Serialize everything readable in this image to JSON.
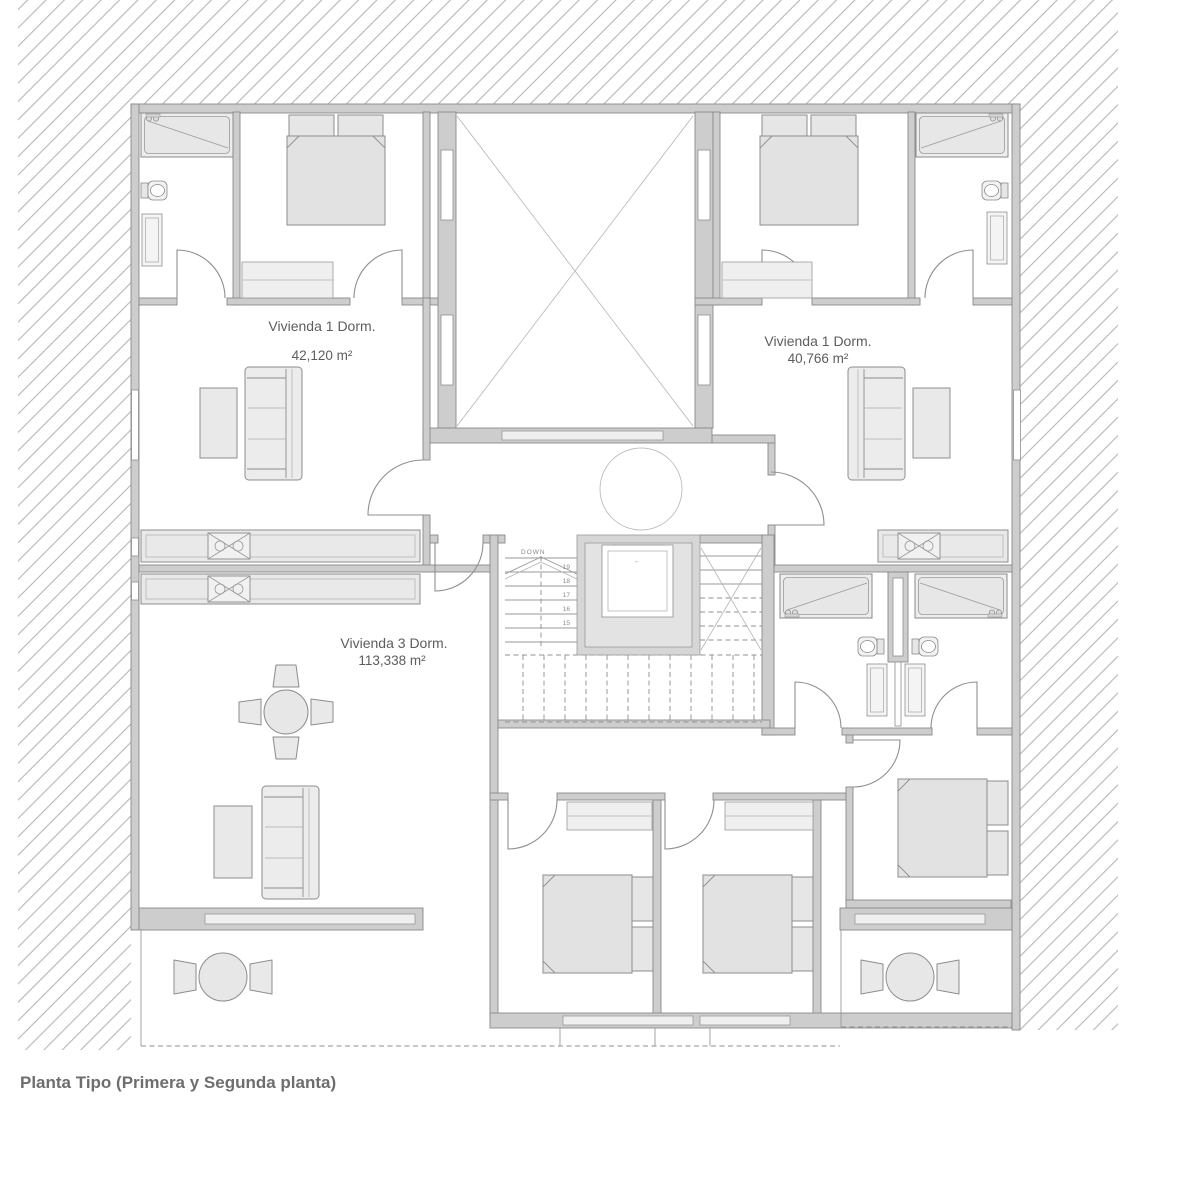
{
  "caption": "Planta Tipo (Primera y Segunda planta)",
  "units": [
    {
      "name": "Vivienda  1 Dorm.",
      "area": "42,120 m²"
    },
    {
      "name": "Vivienda 1 Dorm.",
      "area": "40,766 m²"
    },
    {
      "name": "Vivienda 3 Dorm.",
      "area": "113,338 m²"
    }
  ],
  "stairs": {
    "down_label": "DOWN",
    "tread_numbers": [
      "19",
      "18",
      "17",
      "16",
      "15"
    ]
  },
  "elevator": {
    "symbol": "←"
  },
  "colors": {
    "background": "#ffffff",
    "wall_fill": "#cdcdcd",
    "wall_stroke": "#8a8a8a",
    "furniture_fill": "#e9e9e9",
    "hatch_line": "#b6b6b6",
    "label_text": "#5d5d5d",
    "caption_text": "#6e6e6e"
  }
}
